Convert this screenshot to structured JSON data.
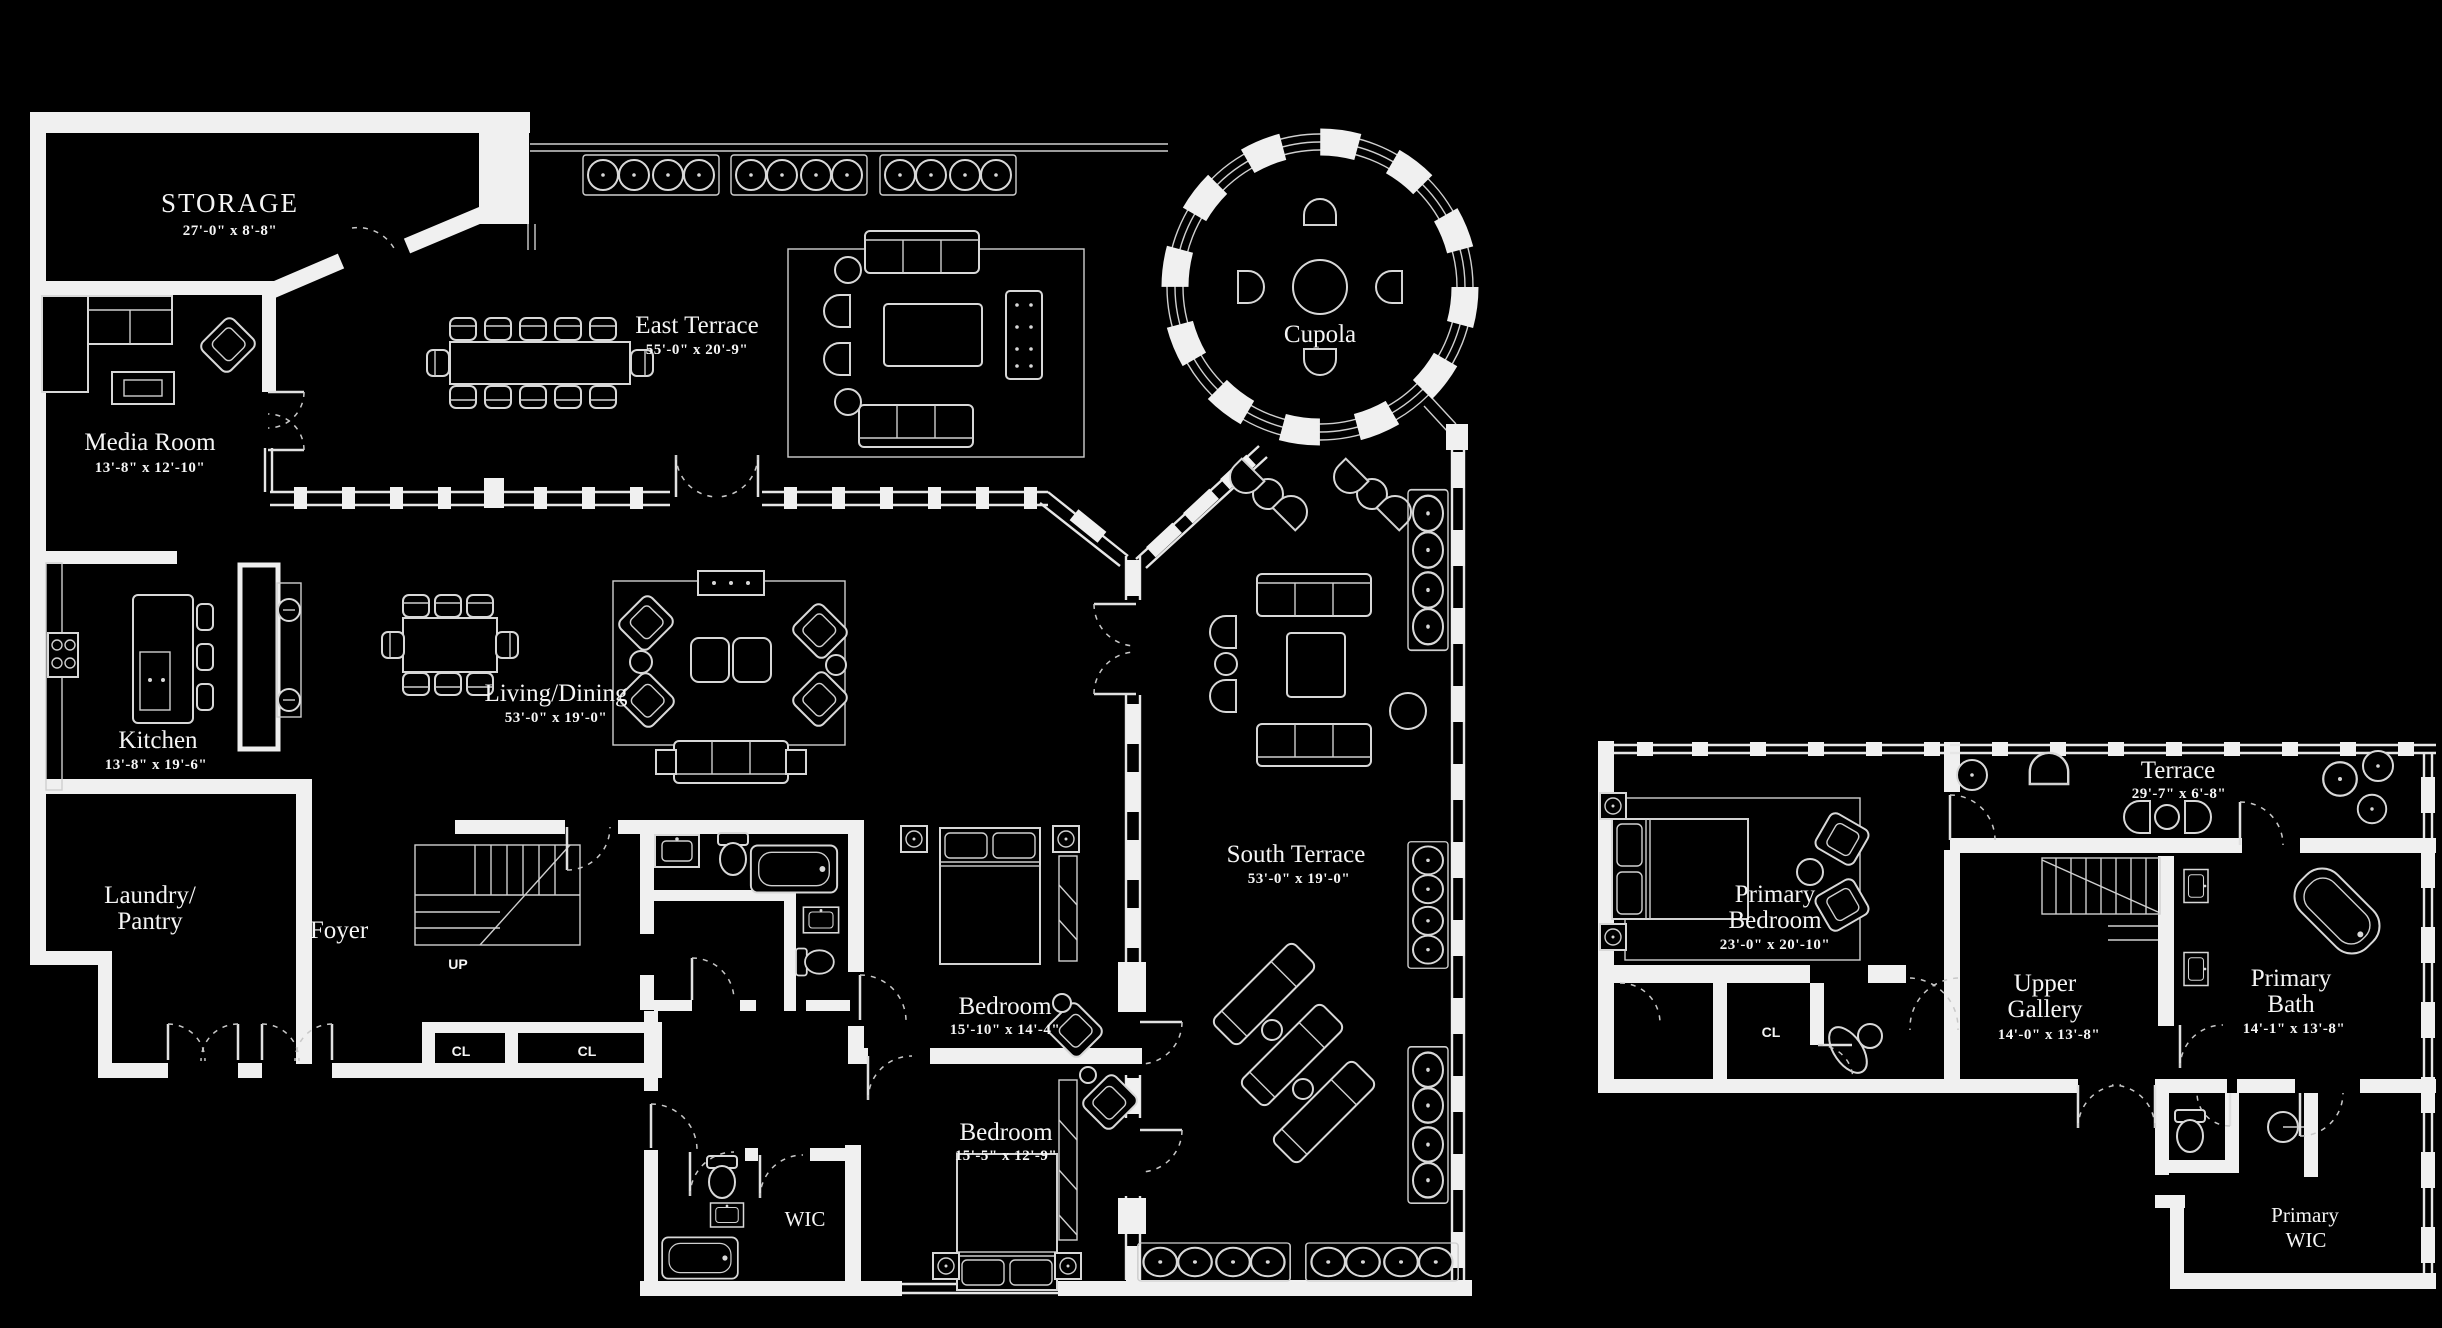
{
  "colors": {
    "background": "#000000",
    "walls": "#f0f0f0",
    "lines": "#d8d8d8",
    "text": "#f5f5f5"
  },
  "floor1": {
    "storage": {
      "name": "STORAGE",
      "dims": "27'-0\" x 8'-8\""
    },
    "media_room": {
      "name": "Media Room",
      "dims": "13'-8\" x 12'-10\""
    },
    "east_terrace": {
      "name": "East Terrace",
      "dims": "55'-0\" x 20'-9\""
    },
    "cupola": {
      "name": "Cupola"
    },
    "kitchen": {
      "name": "Kitchen",
      "dims": "13'-8\" x 19'-6\""
    },
    "living_dining": {
      "name": "Living/Dining",
      "dims": "53'-0\" x 19'-0\""
    },
    "laundry": {
      "line1": "Laundry/",
      "line2": "Pantry"
    },
    "foyer": {
      "name": "Foyer"
    },
    "stair": {
      "label": "UP"
    },
    "closet1": {
      "label": "CL"
    },
    "closet2": {
      "label": "CL"
    },
    "bedroom1": {
      "name": "Bedroom",
      "dims": "15'-10\" x 14'-4\""
    },
    "bedroom2": {
      "name": "Bedroom",
      "dims": "15'-5\" x 12'-9\""
    },
    "wic": {
      "label": "WIC"
    },
    "south_terrace": {
      "name": "South Terrace",
      "dims": "53'-0\" x 19'-0\""
    }
  },
  "floor2": {
    "primary_bedroom": {
      "line1": "Primary",
      "line2": "Bedroom",
      "dims": "23'-0\" x 20'-10\""
    },
    "terrace": {
      "name": "Terrace",
      "dims": "29'-7\" x 6'-8\""
    },
    "upper_gallery": {
      "line1": "Upper",
      "line2": "Gallery",
      "dims": "14'-0\" x 13'-8\""
    },
    "primary_bath": {
      "line1": "Primary",
      "line2": "Bath",
      "dims": "14'-1\" x 13'-8\""
    },
    "closet": {
      "label": "CL"
    },
    "primary_wic": {
      "line1": "Primary",
      "line2": "WIC"
    }
  }
}
